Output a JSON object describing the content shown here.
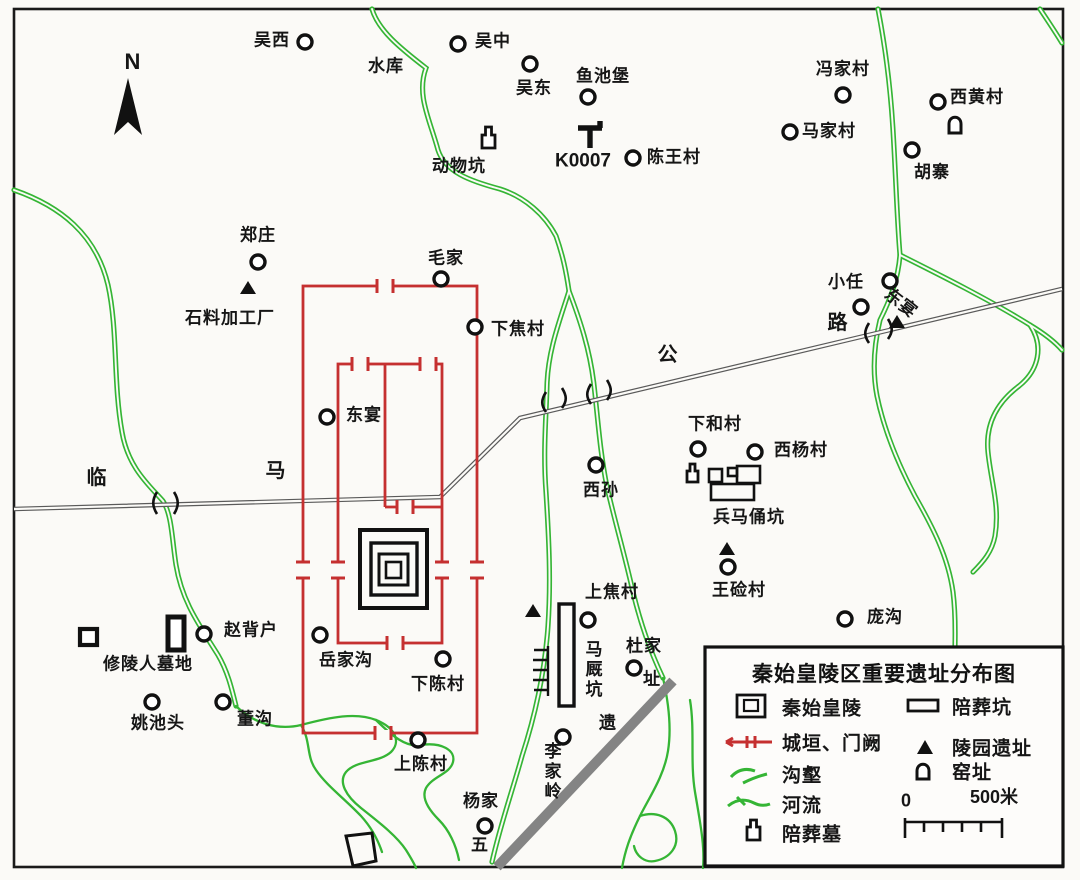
{
  "title": "秦始皇陵区重要遗址分布图",
  "compass": {
    "label": "N"
  },
  "road": {
    "name_chars": [
      "临",
      "马",
      "公",
      "路"
    ]
  },
  "colors": {
    "wall_red": "#c53030",
    "river_green": "#35b535",
    "road_gray": "#5a5a5a",
    "band_gray": "#848484",
    "ink": "#161616",
    "background": "#fbfaf7"
  },
  "map_labels": [
    {
      "text": "吴西"
    },
    {
      "text": "吴中"
    },
    {
      "text": "吴东"
    },
    {
      "text": "水库"
    },
    {
      "text": "鱼池堡"
    },
    {
      "text": "动物坑"
    },
    {
      "text": "K0007"
    },
    {
      "text": "陈王村"
    },
    {
      "text": "冯家村"
    },
    {
      "text": "西黄村"
    },
    {
      "text": "马家村"
    },
    {
      "text": "胡寨"
    },
    {
      "text": "郑庄"
    },
    {
      "text": "石料加工厂"
    },
    {
      "text": "毛家"
    },
    {
      "text": "下焦村"
    },
    {
      "text": "东宴"
    },
    {
      "text": "临"
    },
    {
      "text": "马"
    },
    {
      "text": "公"
    },
    {
      "text": "路"
    },
    {
      "text": "小任"
    },
    {
      "text": "东宴"
    },
    {
      "text": "下和村"
    },
    {
      "text": "西杨村"
    },
    {
      "text": "西孙"
    },
    {
      "text": "兵马俑坑"
    },
    {
      "text": "王硷村"
    },
    {
      "text": "庞沟"
    },
    {
      "text": "修陵人墓地"
    },
    {
      "text": "赵背户"
    },
    {
      "text": "岳家沟"
    },
    {
      "text": "姚池头"
    },
    {
      "text": "董沟"
    },
    {
      "text": "下陈村"
    },
    {
      "text": "上陈村"
    },
    {
      "text": "上焦村"
    },
    {
      "text": "马厩坑"
    },
    {
      "text": "杜家"
    },
    {
      "text": "址"
    },
    {
      "text": "遗"
    },
    {
      "text": "李家岭"
    },
    {
      "text": "杨家"
    },
    {
      "text": "五"
    }
  ],
  "legend": {
    "title": "秦始皇陵区重要遗址分布图",
    "items": [
      {
        "icon": "mausoleum-icon",
        "label": "秦始皇陵"
      },
      {
        "icon": "burial-pit-icon",
        "label": "陪葬坑"
      },
      {
        "icon": "wall-gate-icon",
        "label": "城垣、门阙"
      },
      {
        "icon": "park-site-icon",
        "label": "陵园遗址"
      },
      {
        "icon": "gully-icon",
        "label": "沟壑"
      },
      {
        "icon": "kiln-icon",
        "label": "窑址"
      },
      {
        "icon": "river-icon",
        "label": "河流"
      },
      {
        "icon": "burial-tomb-icon",
        "label": "陪葬墓"
      }
    ],
    "scale": {
      "zero": "0",
      "end": "500米"
    }
  }
}
